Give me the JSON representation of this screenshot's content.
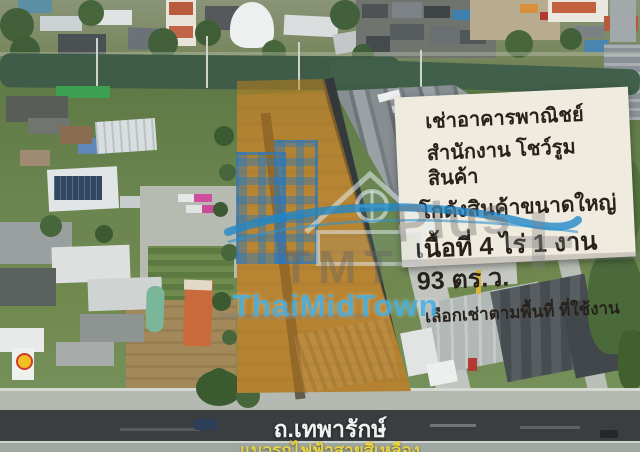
{
  "sign": {
    "line1": "เช่าอาคารพาณิชย์",
    "line2": "สำนักงาน โชว์รูมสินค้า",
    "line3": "โกดังสินค้าขนาดใหญ่",
    "line4": "เนื้อที่ 4 ไร่ 1 งาน 93 ตร.ว.",
    "line5": "เลือกเช่าตามพื้นที่ ที่ใช้งาน"
  },
  "watermark": {
    "tmt": "TMT",
    "plus": "Plus",
    "brand": "ThaiMidTown"
  },
  "road": {
    "name": "ถ.เทพารักษ์",
    "railway_note": "แนวรถไฟฟ้าสายสีเหลือง"
  },
  "icons": {
    "logo_building": "building-icon",
    "logo_house": "house-icon",
    "logo_wave": "wave-icon",
    "logo_cross": "plus-cross-icon",
    "gas_station": "shell-logo-icon"
  },
  "colors": {
    "plot_overlay": "#c6811a",
    "brand_blue": "#40aee5",
    "rail_yellow": "#e8d243",
    "sign_background": "#f0ebdf",
    "asphalt": "#3a3e40",
    "canal_water": "#3e5c48",
    "plot_dirt": "#a5874b"
  }
}
